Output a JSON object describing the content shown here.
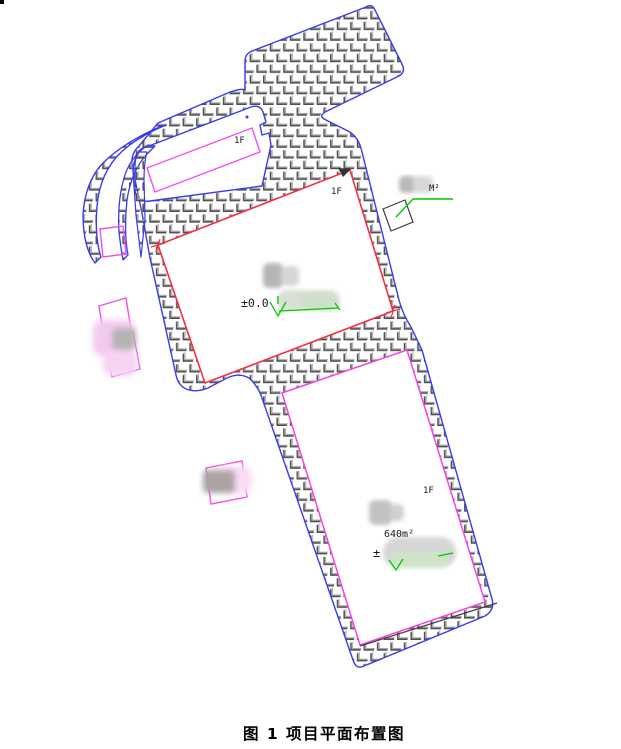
{
  "figure": {
    "caption": "图 1 项目平面布置图",
    "labels": {
      "annex_floor": "1F",
      "main_floor": "1F",
      "south_floor": "1F",
      "main_elevation": "±0.0",
      "south_area": "640m²",
      "south_elevation_prefix": "±",
      "callout_unit": "M²"
    },
    "colors": {
      "boundary_blue": "#3a3af0",
      "main_building_red": "#f43040",
      "annex_magenta": "#ef52ef",
      "south_building_magenta": "#f544e0",
      "outbuilding_magenta": "#ee4fe6",
      "elevation_green": "#00c800",
      "hatch_dark": "#4f4f4f",
      "hatch_light": "#a8a8a8",
      "text_black": "#1a1a1a"
    }
  }
}
